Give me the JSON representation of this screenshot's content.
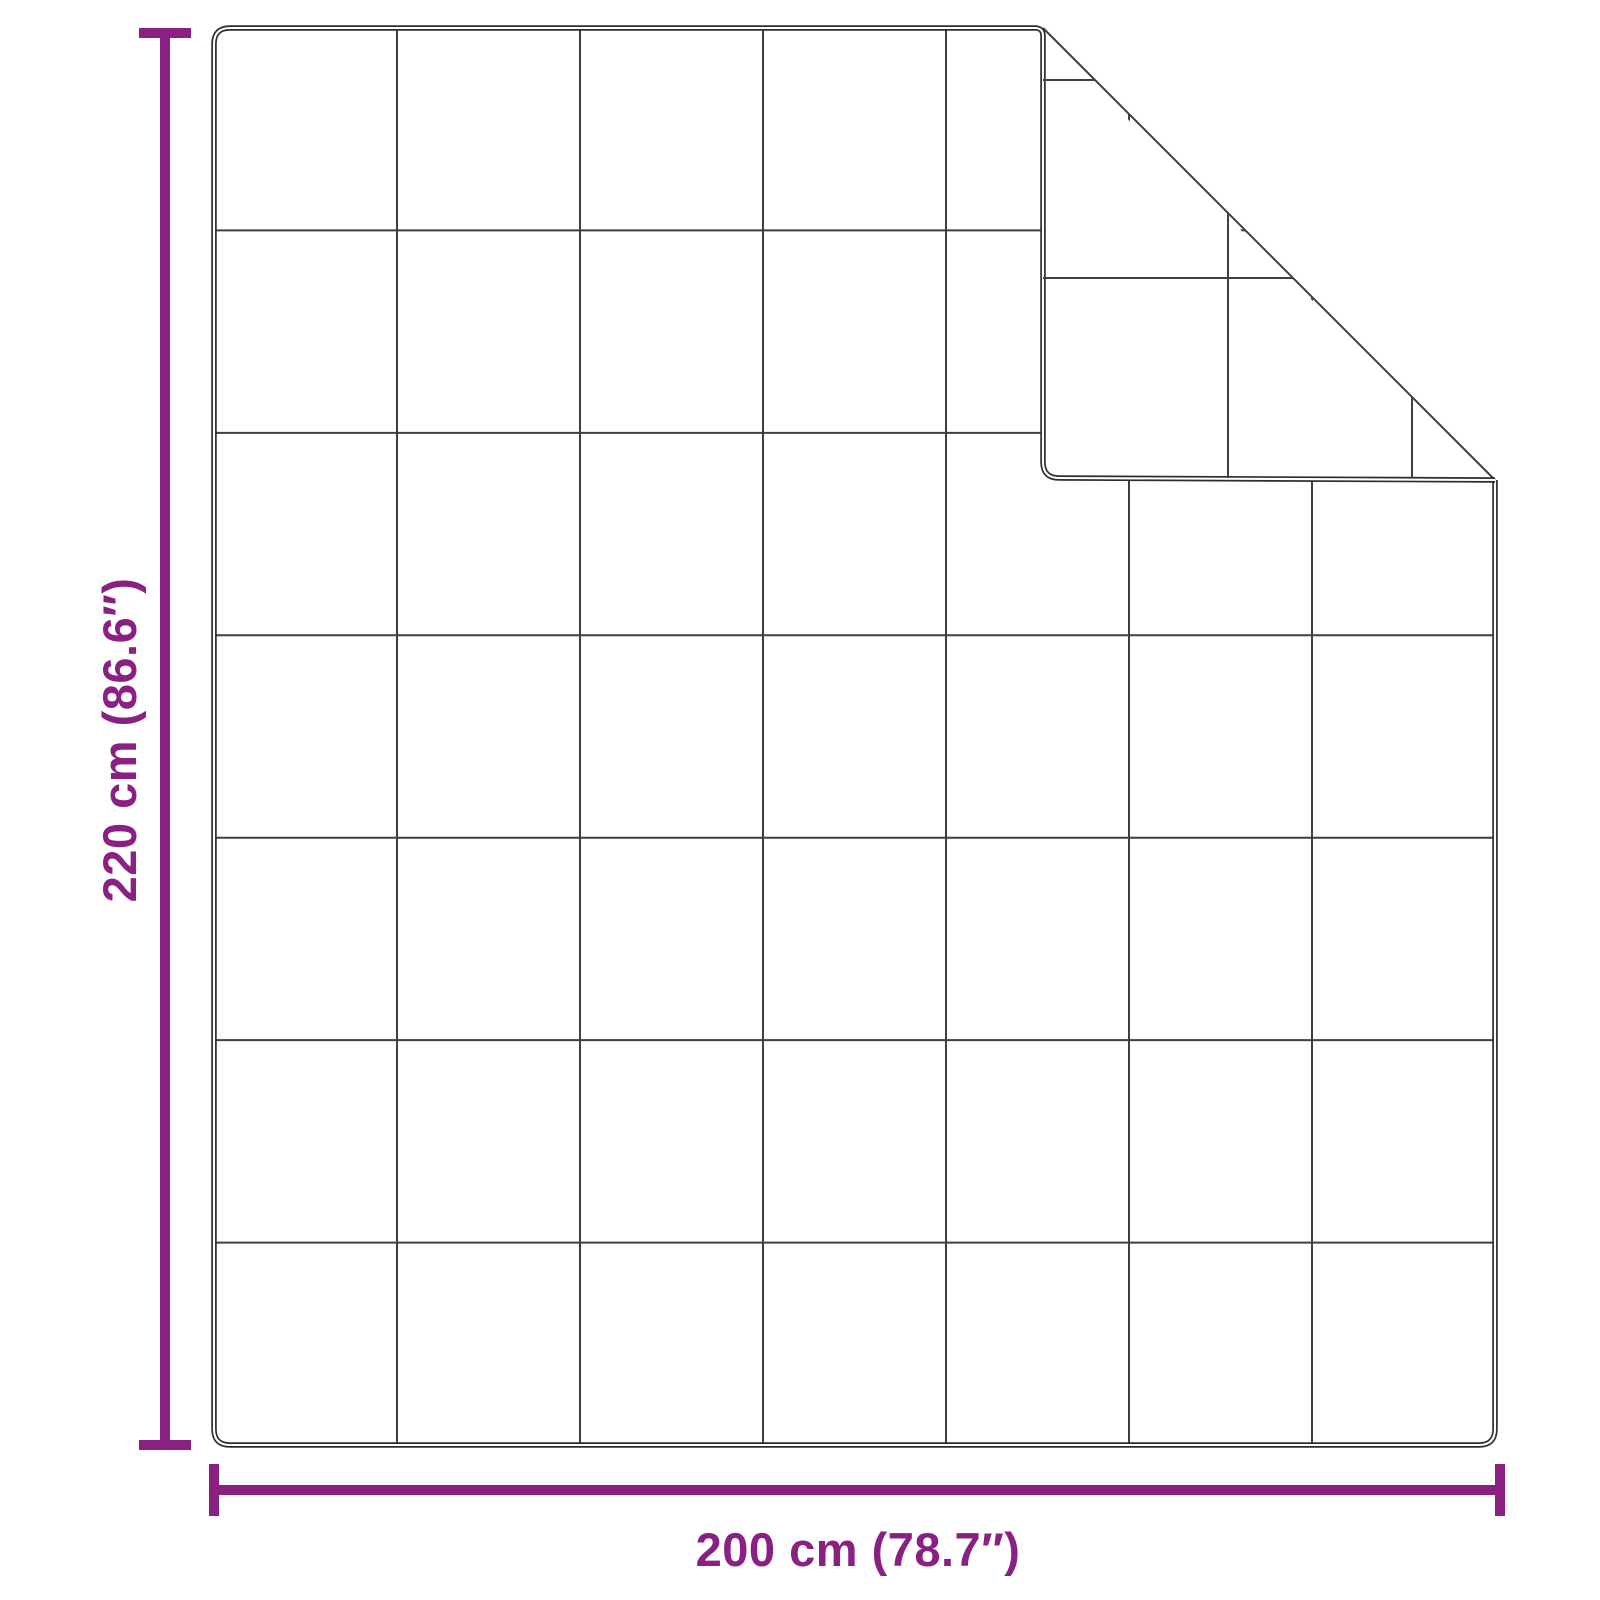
{
  "diagram": {
    "product": "quilted-blanket-with-folded-corner",
    "height_label": "220 cm (86.6″)",
    "width_label": "200 cm (78.7″)",
    "grid": {
      "columns": 7,
      "rows": 7
    },
    "fold": {
      "corner": "top-right"
    },
    "colors": {
      "accent": "#8a2082",
      "outline": "#2d2d2d",
      "grid": "#3f3f3f",
      "background": "#ffffff"
    }
  }
}
